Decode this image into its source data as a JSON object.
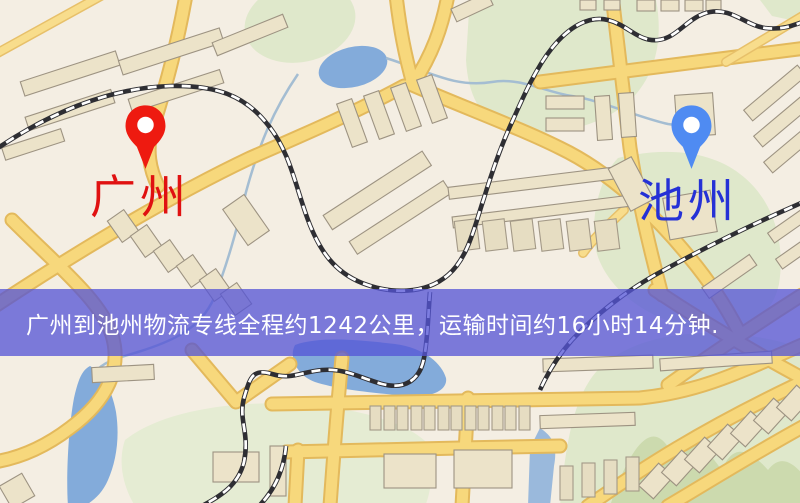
{
  "banner": {
    "text": "广州到池州物流专线全程约1242公里，运输时间约16小时14分钟.",
    "background_color": "#5454d6",
    "text_color": "#ffffff"
  },
  "markers": {
    "origin": {
      "label": "广州",
      "pin_color": "#ee1a10",
      "label_color": "#e01111"
    },
    "destination": {
      "label": "池州",
      "pin_color": "#4f8bf2",
      "label_color": "#2531d6"
    }
  },
  "route_info": {
    "from": "广州",
    "to": "池州",
    "distance_text": "约1242公里",
    "duration_text": "约16小时14分钟"
  },
  "map_colors": {
    "background": "#f4eee3",
    "road_fill": "#f7d87c",
    "road_casing": "#e3b95c",
    "building": "#ece3c9",
    "green_area": "#dfe8cb",
    "water": "#83abda",
    "railway": "#2e2e33"
  }
}
